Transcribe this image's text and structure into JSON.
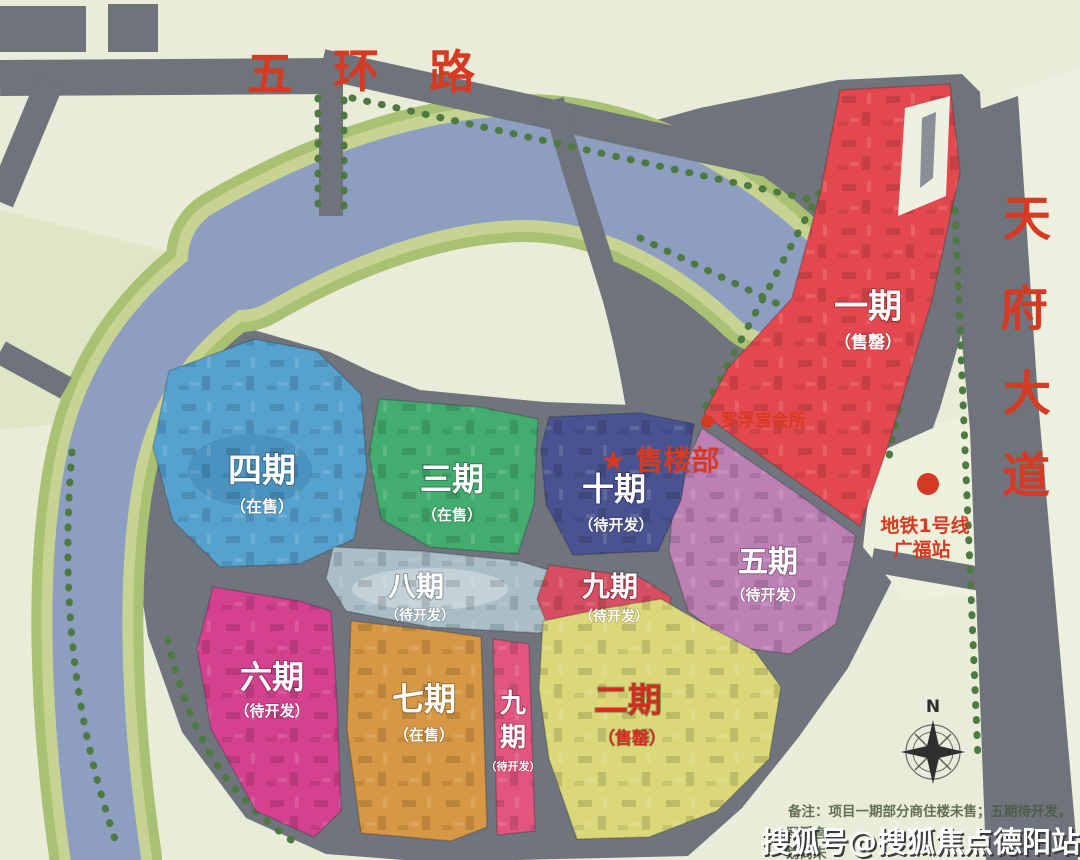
{
  "colors": {
    "accent_red": "#d63a22",
    "note_green": "#4a5a40",
    "compass_dark": "#2f2f2f",
    "watermark_white": "#fdfdfd",
    "watermark_shadow": "#3c3c3c"
  },
  "roads": {
    "wuhuan": "五环路",
    "wuhuan_chars": [
      "五",
      "环",
      "路"
    ],
    "tianfu": "天府大道",
    "tianfu_chars": [
      "天",
      "府",
      "大",
      "道"
    ]
  },
  "pois": {
    "sales_office": "★ 售楼部",
    "club": "● 罗浮宫会所",
    "metro_line": "地铁1号线",
    "metro_station": "广福站"
  },
  "phases": [
    {
      "name": "一期",
      "status": "（售罄）",
      "color": "#e4484f",
      "label_color": "#ffffff"
    },
    {
      "name": "二期",
      "status": "（售罄）",
      "color": "#dbd879",
      "label_color": "#d02c20"
    },
    {
      "name": "三期",
      "status": "（在售）",
      "color": "#43ad70",
      "label_color": "#ffffff"
    },
    {
      "name": "四期",
      "status": "（在售）",
      "color": "#56a2cf",
      "label_color": "#ffffff"
    },
    {
      "name": "五期",
      "status": "（待开发）",
      "color": "#bd80b5",
      "label_color": "#ffffff"
    },
    {
      "name": "六期",
      "status": "（待开发）",
      "color": "#d4418f",
      "label_color": "#ffffff"
    },
    {
      "name": "七期",
      "status": "（在售）",
      "color": "#d69844",
      "label_color": "#ffffff"
    },
    {
      "name": "八期",
      "status": "（待开发）",
      "color": "#a9bec7",
      "label_color": "#ffffff"
    },
    {
      "name": "九期",
      "status": "（待开发）",
      "color": "#d74d61",
      "label_color": "#ffffff"
    },
    {
      "name": "九期",
      "name_chars": [
        "九",
        "期"
      ],
      "status": "（待开发）",
      "color": "#e2557f",
      "label_color": "#ffffff"
    },
    {
      "name": "十期",
      "status": "（待开发）",
      "color": "#4a5391",
      "label_color": "#ffffff"
    }
  ],
  "compass": {
    "north": "N"
  },
  "notes": {
    "line1": "备注：项目一期部分商住楼未售；五期待开发，",
    "line2": "罗浮宫",
    "line3": "划尚未"
  },
  "watermark": "搜狐号@搜狐焦点德阳站"
}
